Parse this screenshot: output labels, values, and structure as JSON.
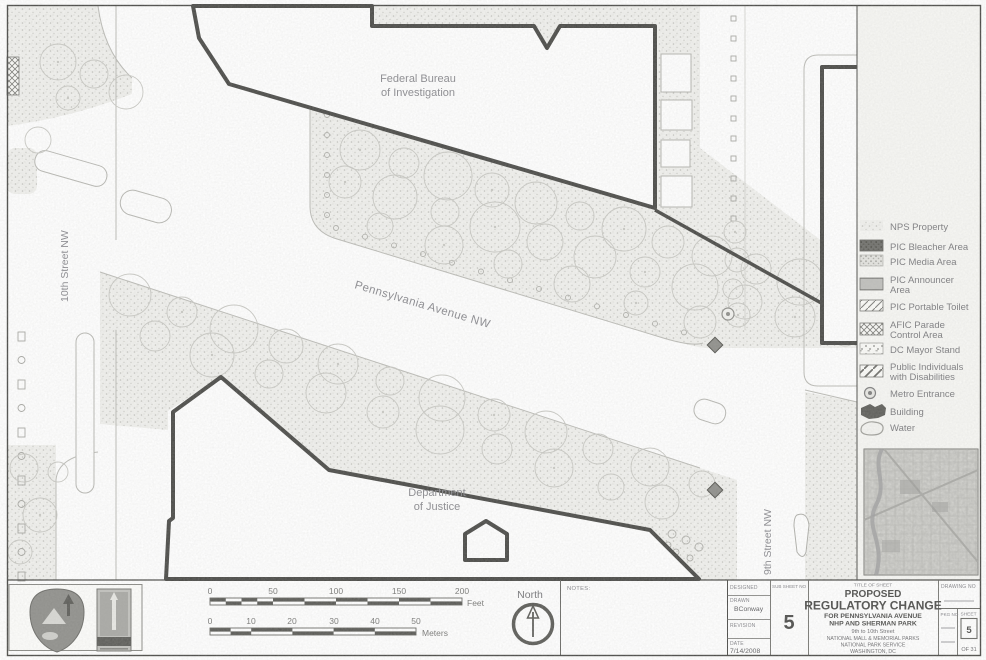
{
  "map": {
    "labels": {
      "fbi_line1": "Federal Bureau",
      "fbi_line2": "of Investigation",
      "doj_line1": "Department",
      "doj_line2": "of Justice",
      "penn_ave": "Pennsylvania Avenue NW",
      "street_10th": "10th Street NW",
      "street_9th": "9th Street NW"
    }
  },
  "legend": {
    "items": [
      {
        "label": "NPS Property",
        "swatch": "nps-stipple"
      },
      {
        "label": "PIC Bleacher Area",
        "swatch": "dark-fill"
      },
      {
        "label": "PIC Media Area",
        "swatch": "dense-stipple"
      },
      {
        "label_line1": "PIC Announcer",
        "label_line2": "Area",
        "swatch": "horizontal-lines"
      },
      {
        "label": "PIC Portable Toilet",
        "swatch": "diagonal-hatch"
      },
      {
        "label_line1": "AFIC Parade",
        "label_line2": "Control Area",
        "swatch": "crosshatch"
      },
      {
        "label": "DC Mayor Stand",
        "swatch": "sparse-dots"
      },
      {
        "label_line1": "Public Individuals",
        "label_line2": "with Disabilities",
        "swatch": "wide-diagonal"
      },
      {
        "label": "Metro Entrance",
        "swatch": "metro-circle-icon"
      },
      {
        "label": "Building",
        "swatch": "building-icon"
      },
      {
        "label": "Water",
        "swatch": "water-icon"
      }
    ]
  },
  "scale_bar": {
    "feet": {
      "ticks": [
        "0",
        "50",
        "100",
        "150",
        "200"
      ],
      "unit": "Feet"
    },
    "meters": {
      "ticks": [
        "0",
        "10",
        "20",
        "30",
        "40",
        "50"
      ],
      "unit": "Meters"
    }
  },
  "north_arrow": {
    "label": "North"
  },
  "notes": {
    "label": "NOTES:"
  },
  "title_block": {
    "designed_label": "DESIGNED",
    "drawn_label": "DRAWN",
    "drawn_value": "BConway",
    "revision_label": "REVISION",
    "date_label": "DATE",
    "date_value": "7/14/2008",
    "sub_sheet_label": "SUB SHEET NO",
    "sub_sheet_value": "5",
    "title_of_sheet_label": "TITLE OF SHEET",
    "title_line1": "PROPOSED",
    "title_line2": "REGULATORY CHANGE",
    "title_line3": "FOR PENNSYLVANIA AVENUE",
    "title_line4": "NHP AND SHERMAN PARK",
    "subtitle_line1": "9th to 10th Street",
    "subtitle_line2": "NATIONAL MALL & MEMORIAL PARKS",
    "subtitle_line3": "NATIONAL PARK SERVICE",
    "subtitle_line4": "WASHINGTON, DC",
    "drawing_no_label": "DRAWING NO",
    "pkg_no_label": "PKG NO",
    "sheet_label": "SHEET",
    "sheet_value": "5",
    "sheet_of": "OF 31"
  },
  "colors": {
    "outline": "#4b4b48",
    "stipple_dot": "#c4c4bf",
    "text_gray": "#8b8b90",
    "dark_swatch": "#70706c"
  }
}
